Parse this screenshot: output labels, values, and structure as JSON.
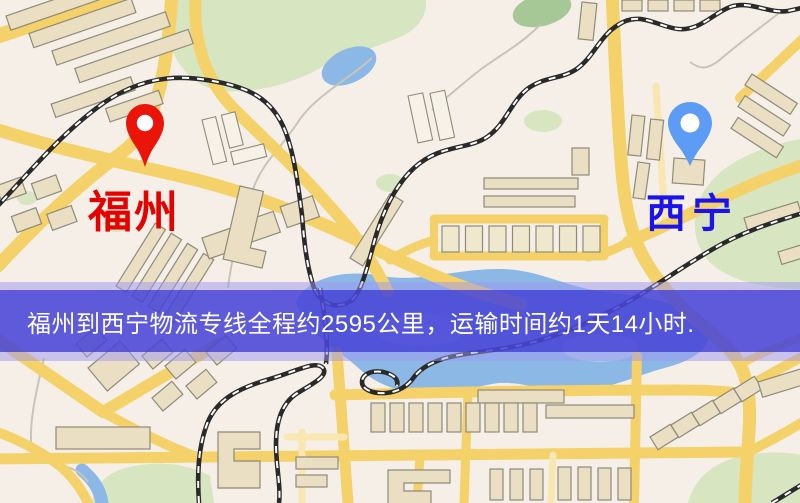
{
  "map": {
    "markers": {
      "origin": {
        "label": "福州"
      },
      "destination": {
        "label": "西宁"
      }
    }
  },
  "banner": {
    "text": "福州到西宁物流专线全程约2595公里，运输时间约1天14小时.",
    "origin": "福州",
    "destination": "西宁",
    "distance_km": "2595",
    "duration": "1天14小时"
  },
  "palette": {
    "map_base": "#f5efe8",
    "road": "#f5d169",
    "road_minor": "#f8e7b0",
    "building": "#eadfc2",
    "building_stroke": "#8e8b7a",
    "building_light": "#f6f2e7",
    "park": "#d7e5c1",
    "park_dark": "#a6c897",
    "water": "#8cb8e6",
    "water_light": "#aecfee",
    "rail_dark": "#2a2a2a",
    "stream": "#c9c4b9",
    "pin_origin": "#ea1508",
    "pin_dest": "#5d9cf5",
    "label_origin": "#e60000",
    "label_dest": "#1a13ee",
    "banner_bg": "#4946d6",
    "banner_text": "#ffffff"
  }
}
